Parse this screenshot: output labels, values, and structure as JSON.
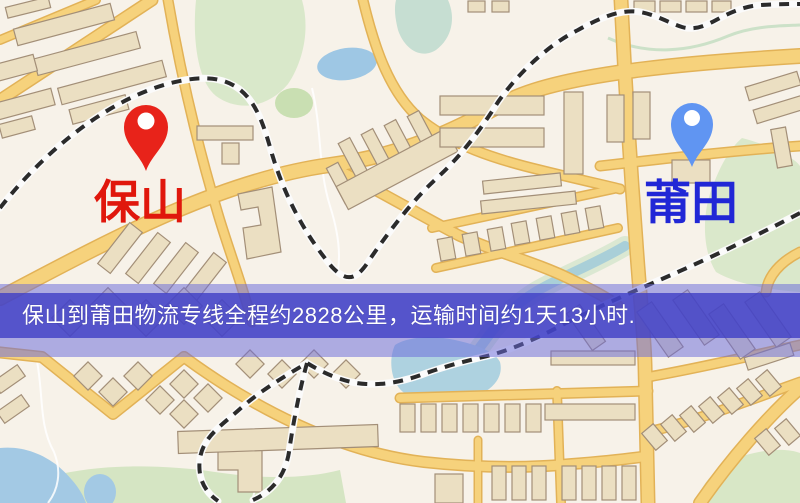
{
  "map": {
    "origin": {
      "label": "保山",
      "pin_color": "#e8231a",
      "label_color": "#e0170c"
    },
    "destination": {
      "label": "莆田",
      "pin_color": "#6095f2",
      "label_color": "#2127d6"
    },
    "palette": {
      "background": "#f7f2e9",
      "road_fill": "#f6d27c",
      "road_casing": "#e2b257",
      "railway_dash": "#2b2b2b",
      "building": "#ebdfc2",
      "park_green": "#d9e8ca",
      "water_blue": "#9ec7e4",
      "river_teal": "#a9cfd8"
    }
  },
  "banner": {
    "text": "保山到莆田物流专线全程约2828公里，运输时间约1天13小时.",
    "text_color": "#ffffff",
    "band_color": "#3e3ec6",
    "overlay_color": "#6a6adb"
  },
  "route": {
    "distance_text": "2828公里",
    "duration_text": "1天13小时"
  }
}
